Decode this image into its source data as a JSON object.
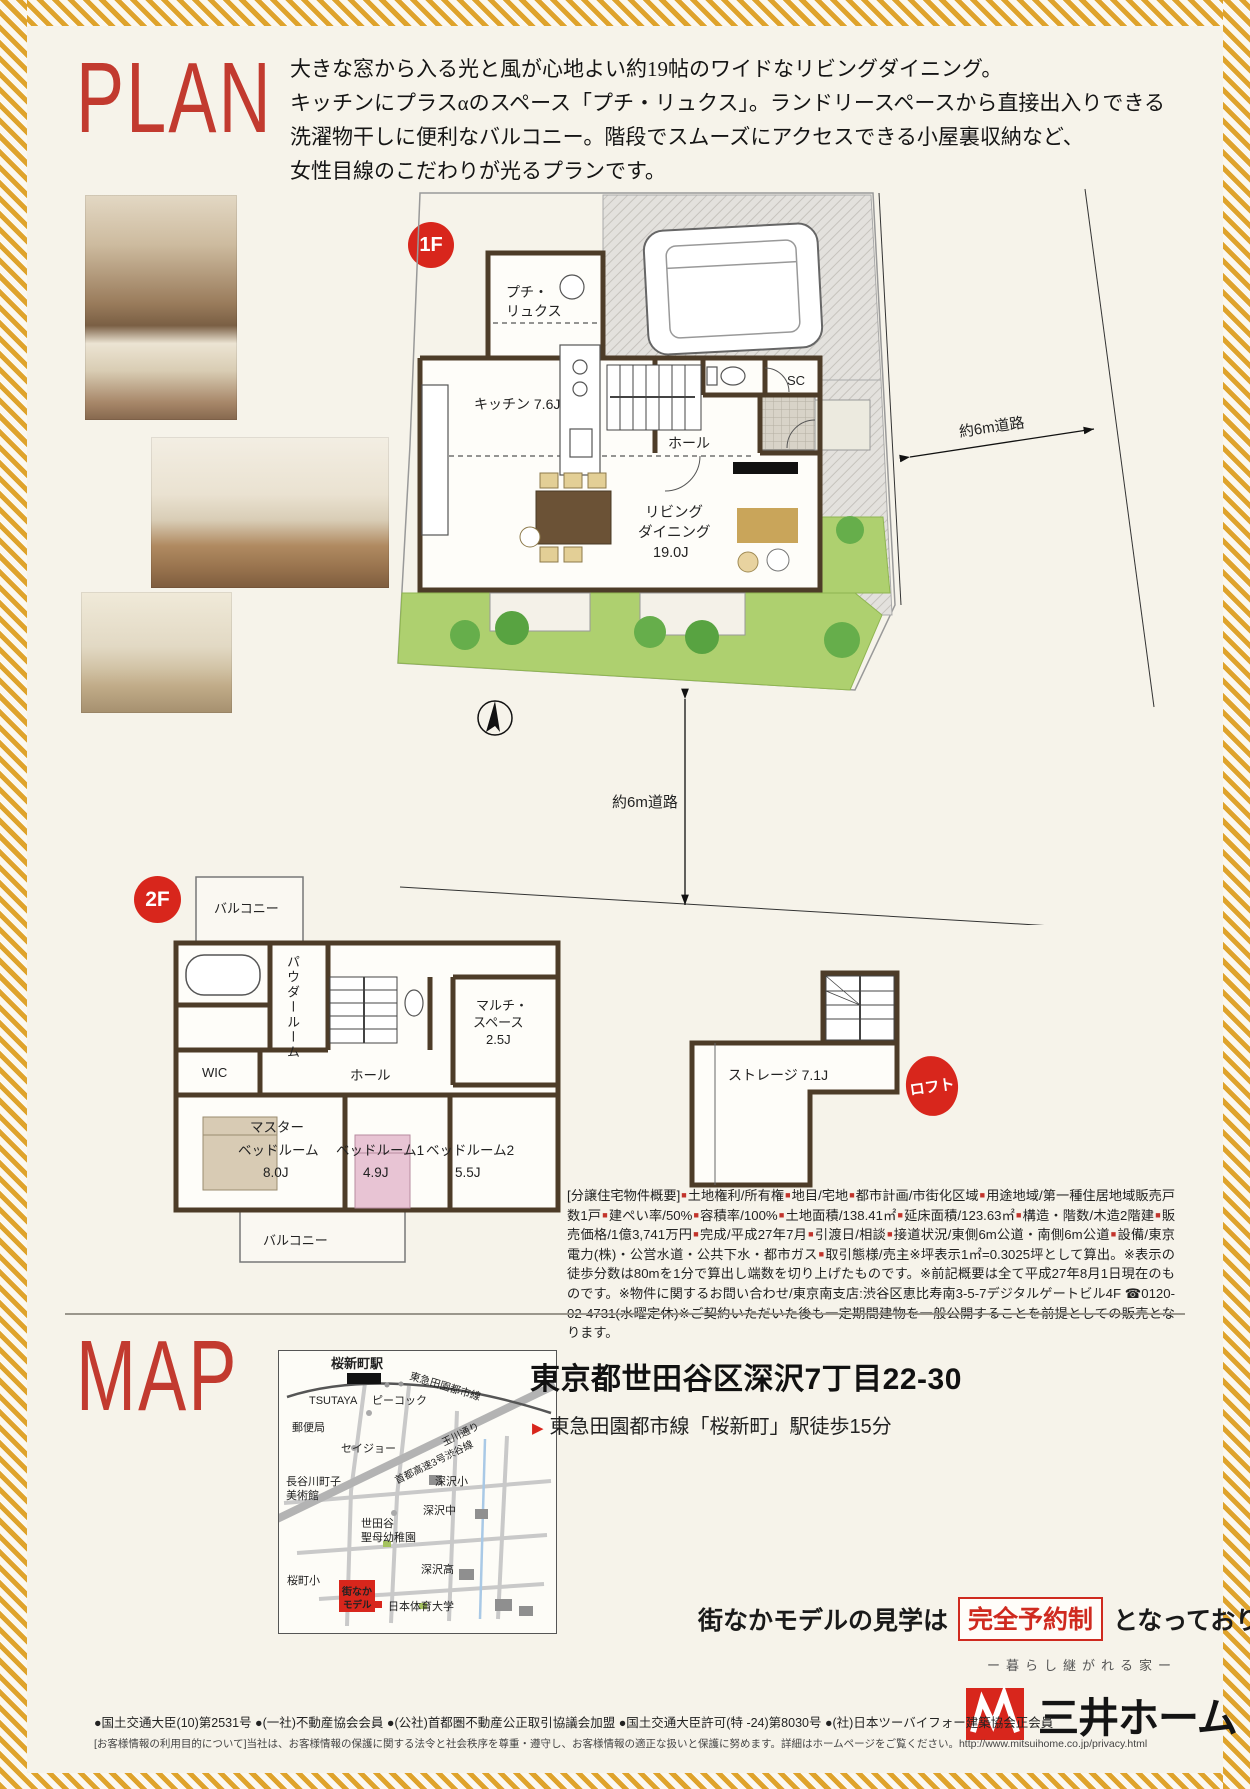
{
  "accent": {
    "red": "#c23a2f",
    "badge_red": "#d8261c"
  },
  "plan": {
    "title": "PLAN",
    "description": [
      "大きな窓から入る光と風が心地よい約19帖のワイドなリビングダイニング。",
      "キッチンにプラスαのスペース「プチ・リュクス」。ランドリースペースから直接出入りできる",
      "洗濯物干しに便利なバルコニー。階段でスムーズにアクセスできる小屋裏収納など、",
      "女性目線のこだわりが光るプランです。"
    ]
  },
  "floor1": {
    "badge": "1F",
    "rooms": {
      "petit1": "プチ・",
      "petit2": "リュクス",
      "kitchen": "キッチン 7.6J",
      "hall": "ホール",
      "sc": "SC",
      "living1": "リビング",
      "living2": "ダイニング",
      "living3": "19.0J"
    },
    "road_right": "約6m道路",
    "road_bottom": "約6m道路"
  },
  "floor2": {
    "badge": "2F",
    "rooms": {
      "balcony_top": "バルコニー",
      "powder": "パウダールーム",
      "wic": "WIC",
      "hall": "ホール",
      "multi1": "マルチ・",
      "multi2": "スペース",
      "multi3": "2.5J",
      "master1": "マスター",
      "master2": "ベッドルーム",
      "master3": "8.0J",
      "bed1a": "ベッドルーム1",
      "bed1b": "4.9J",
      "bed2a": "ベッドルーム2",
      "bed2b": "5.5J",
      "balcony_bottom": "バルコニー"
    }
  },
  "loft": {
    "badge": "ロフト",
    "storage": "ストレージ 7.1J"
  },
  "outline": {
    "text": "[分譲住宅物件概要]■土地権利/所有権■地目/宅地■都市計画/市街化区域■用途地域/第一種住居地域販売戸数1戸■建ぺい率/50%■容積率/100%■土地面積/138.41㎡■延床面積/123.63㎡■構造・階数/木造2階建■販売価格/1億3,741万円■完成/平成27年7月■引渡日/相談■接道状況/東側6m公道・南側6m公道■設備/東京電力(株)・公営水道・公共下水・都市ガス■取引態様/売主※坪表示1㎡=0.3025坪として算出。※表示の徒歩分数は80mを1分で算出し端数を切り上げたものです。※前記概要は全て平成27年8月1日現在のものです。※物件に関するお問い合わせ/東京南支店:渋谷区恵比寿南3-5-7デジタルゲートビル4F ☎0120-02-4731(水曜定休)※ご契約いただいた後も一定期間建物を一般公開することを前提としての販売となります。"
  },
  "map": {
    "title": "MAP",
    "address": "東京都世田谷区深沢7丁目22-30",
    "access_marker": "▶",
    "access": "東急田園都市線「桜新町」駅徒歩15分",
    "labels": {
      "station": "桜新町駅",
      "rail": "東急田園都市線",
      "tsutaya": "TSUTAYA",
      "peacock": "ピーコック",
      "post": "郵便局",
      "seijo": "セイジョー",
      "highway": "首都高速3号渋谷線",
      "tamagawa": "玉川通り",
      "museum1": "長谷川町子",
      "museum2": "美術館",
      "fukasawa_e": "深沢小",
      "fukasawa_j": "深沢中",
      "seibo1": "世田谷",
      "seibo2": "聖母幼稚園",
      "fukasawa_h": "深沢高",
      "sakura_e": "桜町小",
      "model1": "街なか",
      "model2": "モデル",
      "univ": "日本体育大学"
    }
  },
  "booking": {
    "pre": "街なかモデルの見学は",
    "highlight": "完全予約制",
    "post": "となっております"
  },
  "brand": {
    "tagline": "ー暮らし継がれる家ー",
    "logo": "三井ホーム"
  },
  "footer": {
    "line1": "●国土交通大臣(10)第2531号 ●(一社)不動産協会会員 ●(公社)首都圏不動産公正取引協議会加盟 ●国土交通大臣許可(特 -24)第8030号 ●(社)日本ツーバイフォー建築協会正会員",
    "line2": "[お客様情報の利用目的について]当社は、お客様情報の保護に関する法令と社会秩序を尊重・遵守し、お客様情報の適正な扱いと保護に努めます。詳細はホームページをご覧ください。http://www.mitsuihome.co.jp/privacy.html"
  }
}
